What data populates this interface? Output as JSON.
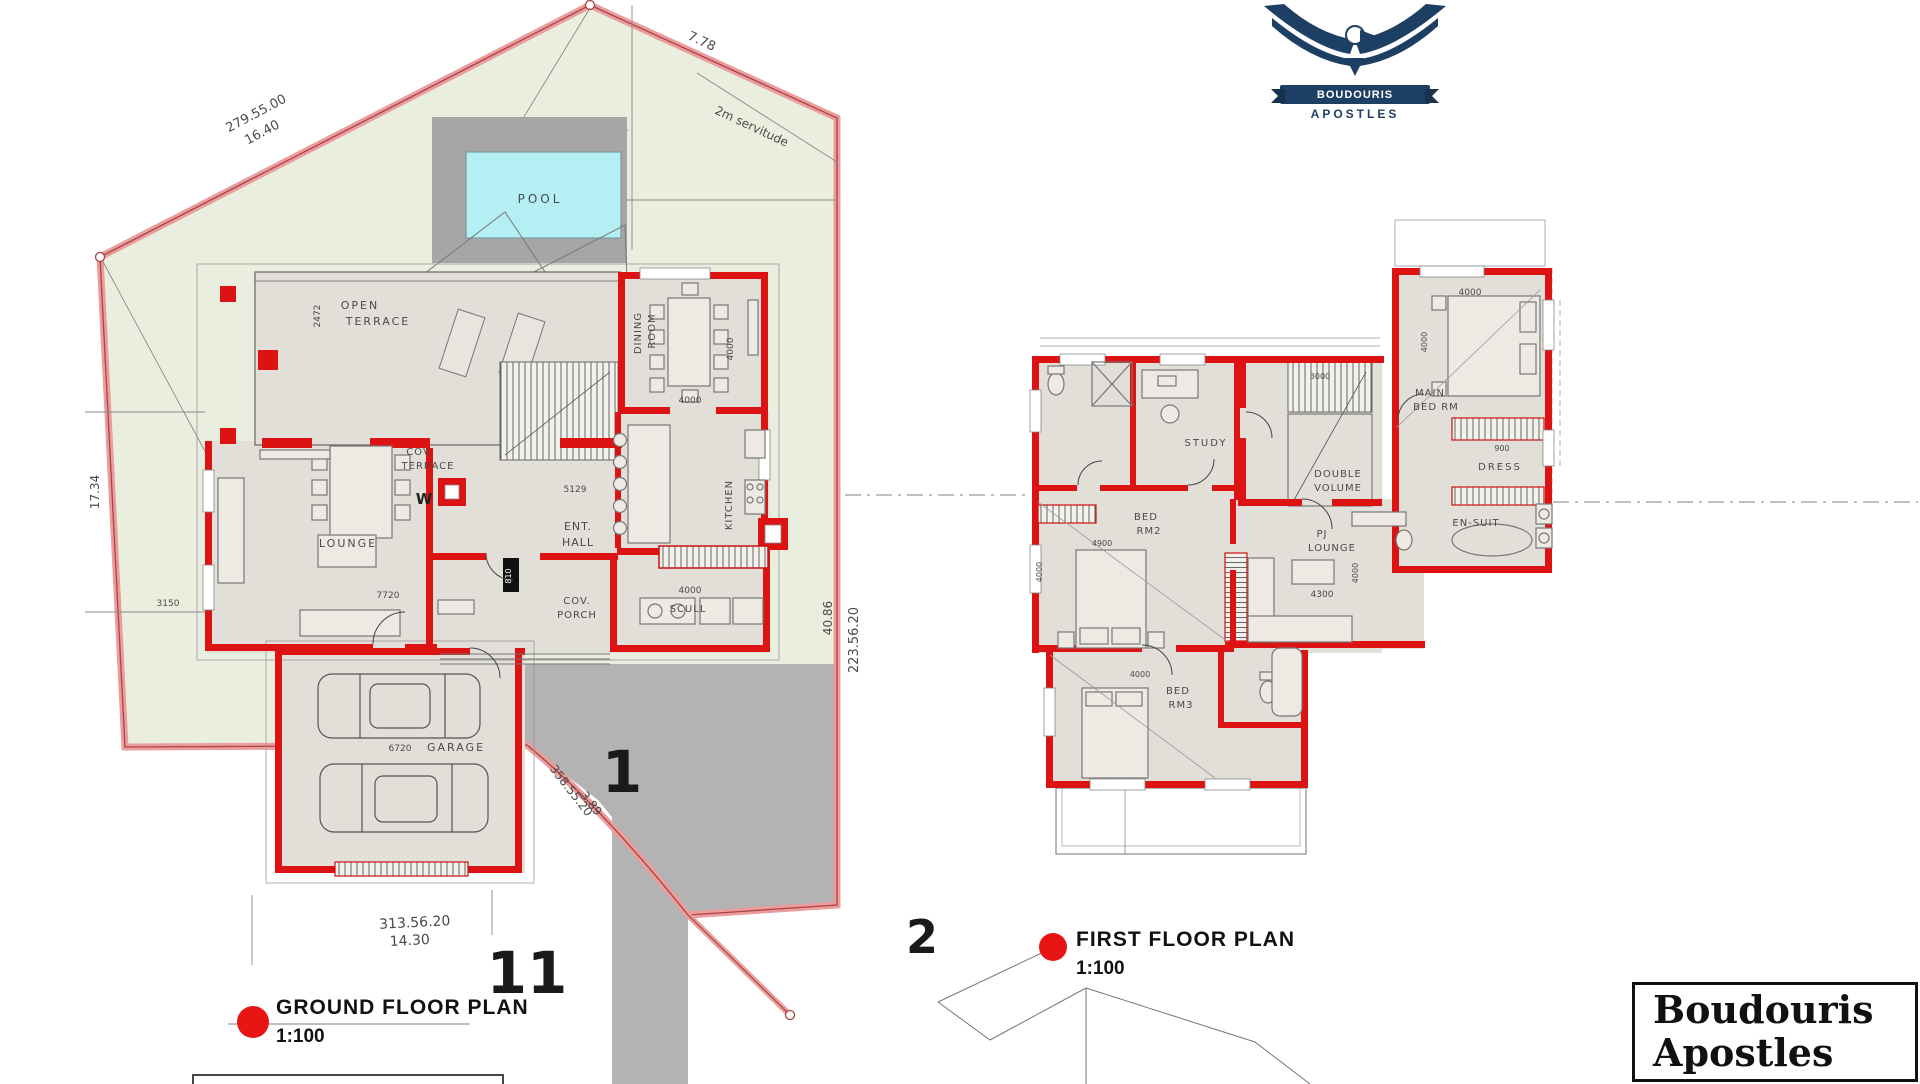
{
  "logo": {
    "banner": "BOUDOURIS",
    "subtitle": "APOSTLES"
  },
  "title_block": {
    "line1": "Boudouris",
    "line2": "Apostles"
  },
  "captions": {
    "ground": {
      "title": "GROUND  FLOOR PLAN",
      "scale": "1:100"
    },
    "first": {
      "title": "FIRST  FLOOR PLAN",
      "scale": "1:100"
    }
  },
  "colors": {
    "wall_red": "#dd1212",
    "lawn_green": "#e9eede",
    "boundary_pink": "#eb9c9c",
    "pool_cyan": "#b4eff4",
    "paving_gray": "#b3b3b3",
    "logo_navy": "#1d3f63"
  },
  "labels": [
    {
      "id": "dim-279-55-00",
      "t": "279.55.00",
      "x": 258,
      "y": 117,
      "s": 13,
      "r": -28
    },
    {
      "id": "dim-16-40",
      "t": "16.40",
      "x": 264,
      "y": 136,
      "s": 13,
      "r": -28
    },
    {
      "id": "dim-7-78",
      "t": "7.78",
      "x": 700,
      "y": 45,
      "s": 13,
      "r": 25
    },
    {
      "id": "servitude-label",
      "t": "2m servitude",
      "x": 750,
      "y": 130,
      "s": 12,
      "r": 25
    },
    {
      "id": "dim-17-34",
      "t": "17.34",
      "x": 99,
      "y": 492,
      "s": 12,
      "r": -90
    },
    {
      "id": "dim-313-56-20",
      "t": "313.56.20",
      "x": 415,
      "y": 927,
      "s": 14,
      "r": -3
    },
    {
      "id": "dim-14-30",
      "t": "14.30",
      "x": 410,
      "y": 945,
      "s": 14,
      "r": -3
    },
    {
      "id": "dim-358-55-20",
      "t": "358.55.20",
      "x": 568,
      "y": 793,
      "s": 12,
      "r": 52
    },
    {
      "id": "dim-3-89",
      "t": "3.89",
      "x": 588,
      "y": 806,
      "s": 12,
      "r": 52
    },
    {
      "id": "dim-223-56-20",
      "t": "223.56.20",
      "x": 858,
      "y": 640,
      "s": 13,
      "r": -90
    },
    {
      "id": "dim-40-86",
      "t": "40.86",
      "x": 832,
      "y": 618,
      "s": 12,
      "r": -90
    },
    {
      "id": "dim-3150",
      "t": "3150",
      "x": 168,
      "y": 606,
      "s": 9
    },
    {
      "id": "lot-number-1",
      "t": "1",
      "x": 622,
      "y": 792,
      "s": 58,
      "w": "bold",
      "c": "#1a1a1a"
    },
    {
      "id": "lot-number-11",
      "t": "11",
      "x": 527,
      "y": 993,
      "s": 58,
      "w": "bold",
      "c": "#1a1a1a"
    },
    {
      "id": "lot-number-2",
      "t": "2",
      "x": 922,
      "y": 953,
      "s": 46,
      "w": "bold",
      "c": "#1a1a1a"
    },
    {
      "id": "room-pool",
      "t": "POOL",
      "x": 540,
      "y": 203,
      "s": 12,
      "ls": 3
    },
    {
      "id": "room-open-terrace-1",
      "t": "OPEN",
      "x": 360,
      "y": 309,
      "s": 11,
      "ls": 2
    },
    {
      "id": "room-open-terrace-2",
      "t": "TERRACE",
      "x": 378,
      "y": 325,
      "s": 11,
      "ls": 2
    },
    {
      "id": "dim-2472",
      "t": "2472",
      "x": 320,
      "y": 316,
      "s": 9,
      "r": -90
    },
    {
      "id": "room-dining-1",
      "t": "DINING",
      "x": 641,
      "y": 333,
      "s": 10,
      "r": -90,
      "ls": 1
    },
    {
      "id": "room-dining-2",
      "t": "ROOM",
      "x": 655,
      "y": 331,
      "s": 10,
      "r": -90,
      "ls": 1
    },
    {
      "id": "dim-4000-dining-v",
      "t": "4000",
      "x": 733,
      "y": 349,
      "s": 9,
      "r": -90
    },
    {
      "id": "dim-4000-dining-h",
      "t": "4000",
      "x": 690,
      "y": 403,
      "s": 9
    },
    {
      "id": "room-cov-terrace-1",
      "t": "COV.",
      "x": 420,
      "y": 455,
      "s": 10,
      "ls": 1
    },
    {
      "id": "room-cov-terrace-2",
      "t": "TERRACE",
      "x": 428,
      "y": 469,
      "s": 10,
      "ls": 1
    },
    {
      "id": "dim-5129",
      "t": "5129",
      "x": 575,
      "y": 492,
      "s": 9
    },
    {
      "id": "room-ent-hall-1",
      "t": "ENT.",
      "x": 578,
      "y": 530,
      "s": 11,
      "ls": 1
    },
    {
      "id": "room-ent-hall-2",
      "t": "HALL",
      "x": 578,
      "y": 546,
      "s": 11,
      "ls": 1
    },
    {
      "id": "room-kitchen",
      "t": "KITCHEN",
      "x": 732,
      "y": 505,
      "s": 10,
      "r": -90,
      "ls": 1
    },
    {
      "id": "room-scull",
      "t": "SCULL",
      "x": 688,
      "y": 612,
      "s": 10,
      "ls": 1
    },
    {
      "id": "dim-4000-scull",
      "t": "4000",
      "x": 690,
      "y": 593,
      "s": 9
    },
    {
      "id": "room-cov-porch-1",
      "t": "COV.",
      "x": 577,
      "y": 604,
      "s": 10,
      "ls": 1
    },
    {
      "id": "room-cov-porch-2",
      "t": "PORCH",
      "x": 577,
      "y": 618,
      "s": 10,
      "ls": 1
    },
    {
      "id": "room-lounge",
      "t": "LOUNGE",
      "x": 348,
      "y": 547,
      "s": 11,
      "ls": 2
    },
    {
      "id": "dim-7720",
      "t": "7720",
      "x": 388,
      "y": 598,
      "s": 9
    },
    {
      "id": "room-garage",
      "t": "GARAGE",
      "x": 456,
      "y": 751,
      "s": 11,
      "ls": 2
    },
    {
      "id": "dim-6720",
      "t": "6720",
      "x": 400,
      "y": 751,
      "s": 9
    },
    {
      "id": "meter-w",
      "t": "W",
      "x": 424,
      "y": 504,
      "s": 15,
      "w": "bold",
      "c": "#222"
    },
    {
      "id": "door-tag-810",
      "t": "810",
      "x": 511,
      "y": 576,
      "s": 8,
      "r": -90,
      "c": "#ffffff"
    },
    {
      "id": "room-study",
      "t": "STUDY",
      "x": 1206,
      "y": 446,
      "s": 10,
      "ls": 2
    },
    {
      "id": "room-double-volume-1",
      "t": "DOUBLE",
      "x": 1338,
      "y": 477,
      "s": 10,
      "ls": 1
    },
    {
      "id": "room-double-volume-2",
      "t": "VOLUME",
      "x": 1338,
      "y": 491,
      "s": 10,
      "ls": 1
    },
    {
      "id": "dim-3000",
      "t": "3000",
      "x": 1320,
      "y": 379,
      "s": 8
    },
    {
      "id": "room-main-bed-1",
      "t": "MAIN",
      "x": 1430,
      "y": 396,
      "s": 10,
      "ls": 1
    },
    {
      "id": "room-main-bed-2",
      "t": "BED RM",
      "x": 1436,
      "y": 410,
      "s": 10,
      "ls": 1
    },
    {
      "id": "dim-4000-mainbed",
      "t": "4000",
      "x": 1470,
      "y": 295,
      "s": 9
    },
    {
      "id": "dim-4000-mainbed-v",
      "t": "4000",
      "x": 1427,
      "y": 342,
      "s": 8,
      "r": -90
    },
    {
      "id": "room-dress",
      "t": "DRESS",
      "x": 1500,
      "y": 470,
      "s": 10,
      "ls": 2
    },
    {
      "id": "dim-900",
      "t": "900",
      "x": 1502,
      "y": 451,
      "s": 8
    },
    {
      "id": "room-bed2-1",
      "t": "BED",
      "x": 1146,
      "y": 520,
      "s": 10,
      "ls": 1
    },
    {
      "id": "room-bed2-2",
      "t": "RM2",
      "x": 1149,
      "y": 534,
      "s": 10,
      "ls": 1
    },
    {
      "id": "dim-4900",
      "t": "4900",
      "x": 1102,
      "y": 546,
      "s": 8
    },
    {
      "id": "dim-4000-bed2-v",
      "t": "4000",
      "x": 1042,
      "y": 572,
      "s": 8,
      "r": -90
    },
    {
      "id": "room-pj-1",
      "t": "PJ",
      "x": 1322,
      "y": 537,
      "s": 10,
      "ls": 1
    },
    {
      "id": "room-pj-2",
      "t": "LOUNGE",
      "x": 1332,
      "y": 551,
      "s": 10,
      "ls": 1
    },
    {
      "id": "dim-4300",
      "t": "4300",
      "x": 1322,
      "y": 597,
      "s": 9
    },
    {
      "id": "dim-4000-pj-v",
      "t": "4000",
      "x": 1358,
      "y": 573,
      "s": 8,
      "r": -90
    },
    {
      "id": "room-ensuit",
      "t": "EN-SUIT",
      "x": 1476,
      "y": 526,
      "s": 10,
      "ls": 1
    },
    {
      "id": "room-bed3-1",
      "t": "BED",
      "x": 1178,
      "y": 694,
      "s": 10,
      "ls": 1
    },
    {
      "id": "room-bed3-2",
      "t": "RM3",
      "x": 1181,
      "y": 708,
      "s": 10,
      "ls": 1
    },
    {
      "id": "dim-4000-bed3",
      "t": "4000",
      "x": 1140,
      "y": 677,
      "s": 8
    }
  ]
}
